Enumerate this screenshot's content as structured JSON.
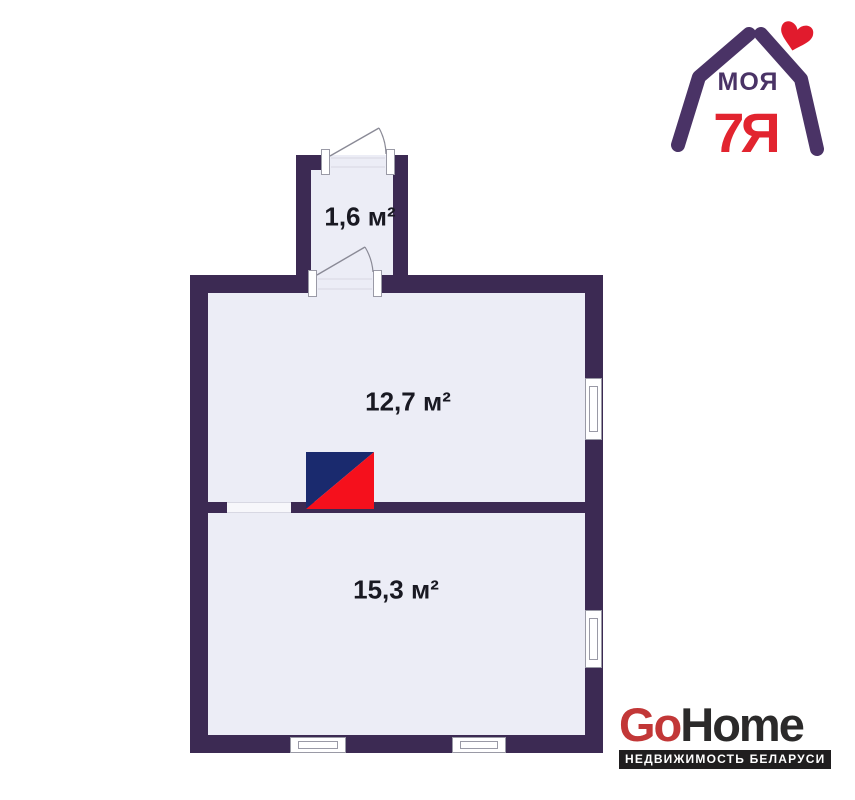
{
  "colors": {
    "wall": "#3c2a53",
    "floor": "#ecedf6",
    "line": "#8a8a96",
    "faint": "#d8d8e3",
    "frame": "#9a9aa6",
    "label": "#191922",
    "stoveNavy": "#1a2a6e",
    "stoveRed": "#f5101c",
    "logoPurple": "#4a3366",
    "logoRed": "#e2242f",
    "heartRed": "#e11b2d",
    "gohomeRed": "#c23737",
    "gohomeDark": "#2b2a2a",
    "taglineBg": "#201e1f",
    "taglineText": "#ffffff"
  },
  "floor_plan": {
    "rooms": [
      {
        "name": "vestibule",
        "area_label": "1,6 м²"
      },
      {
        "name": "upper_room",
        "area_label": "12,7 м²"
      },
      {
        "name": "lower_room",
        "area_label": "15,3 м²"
      }
    ]
  },
  "branding": {
    "moya7ya": {
      "line1": "МОЯ",
      "line2": "7Я"
    },
    "gohome": {
      "go": "Go",
      "home": "Home",
      "tagline": "НЕДВИЖИМОСТЬ БЕЛАРУСИ"
    }
  }
}
